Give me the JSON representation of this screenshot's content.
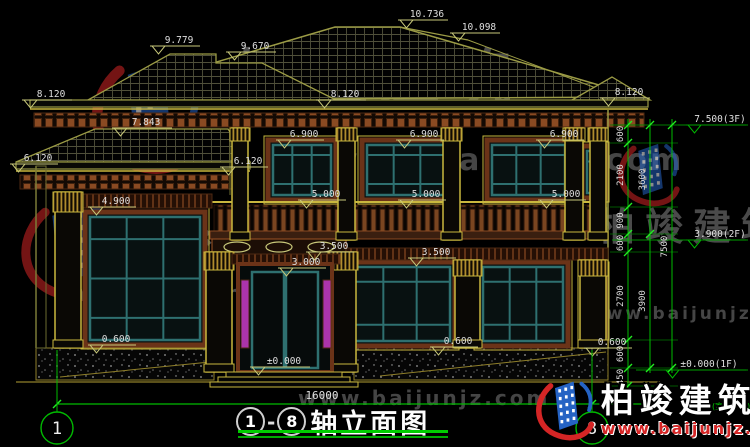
{
  "page": {
    "background": "#000000"
  },
  "colors": {
    "line_olive": "#9b9b45",
    "trim_yellow": "#c9b73e",
    "brown": "#8a4a22",
    "teal_frame": "#2e7070",
    "dim_green": "#00bb00",
    "tick_green": "#22ee22",
    "label_text": "#dfdfdf",
    "magenta_glass": "#c83cc8",
    "logo_blue": "#2563c4",
    "logo_red": "#d42525",
    "watermark_gray": "#4a4a4a"
  },
  "axes": {
    "start": "1",
    "end": "8"
  },
  "title_block": {
    "separator": "-",
    "title": "轴立面图"
  },
  "dimensions": {
    "total_width": "16000",
    "right_inner": [
      "600",
      "2100",
      "900",
      "600",
      "2700",
      "600",
      "450"
    ],
    "right_mid": [
      "3600",
      "3900"
    ],
    "right_outer": [
      "7500"
    ],
    "ground_note": "(室外地面)"
  },
  "elevations": {
    "ridge": "10.736",
    "ridge2": "10.098",
    "roof_l1": "9.779",
    "roof_l2": "9.670",
    "eave_left": "8.120",
    "eave_center": "8.120",
    "eave_right": "8.120",
    "frieze": "7.843",
    "floor3": "7.500(3F)",
    "win2_l": "6.900",
    "win2_c": "6.900",
    "win2_r": "6.900",
    "wing_eave_l": "6.120",
    "wing_eave_c": "6.120",
    "rail_l": "5.000",
    "rail_c": "5.000",
    "rail_r": "5.000",
    "wing_win": "4.900",
    "floor2": "3.900(2F)",
    "lintel_l": "3.500",
    "lintel_r": "3.500",
    "door_top": "3.000",
    "sill_l": "0.600",
    "sill_c": "0.600",
    "sill_r": "0.600",
    "zero": "±0.000",
    "floor1": "±0.000(1F)"
  },
  "watermark": {
    "brand": "柏竣建筑",
    "url": "www.baijunjz.com"
  }
}
